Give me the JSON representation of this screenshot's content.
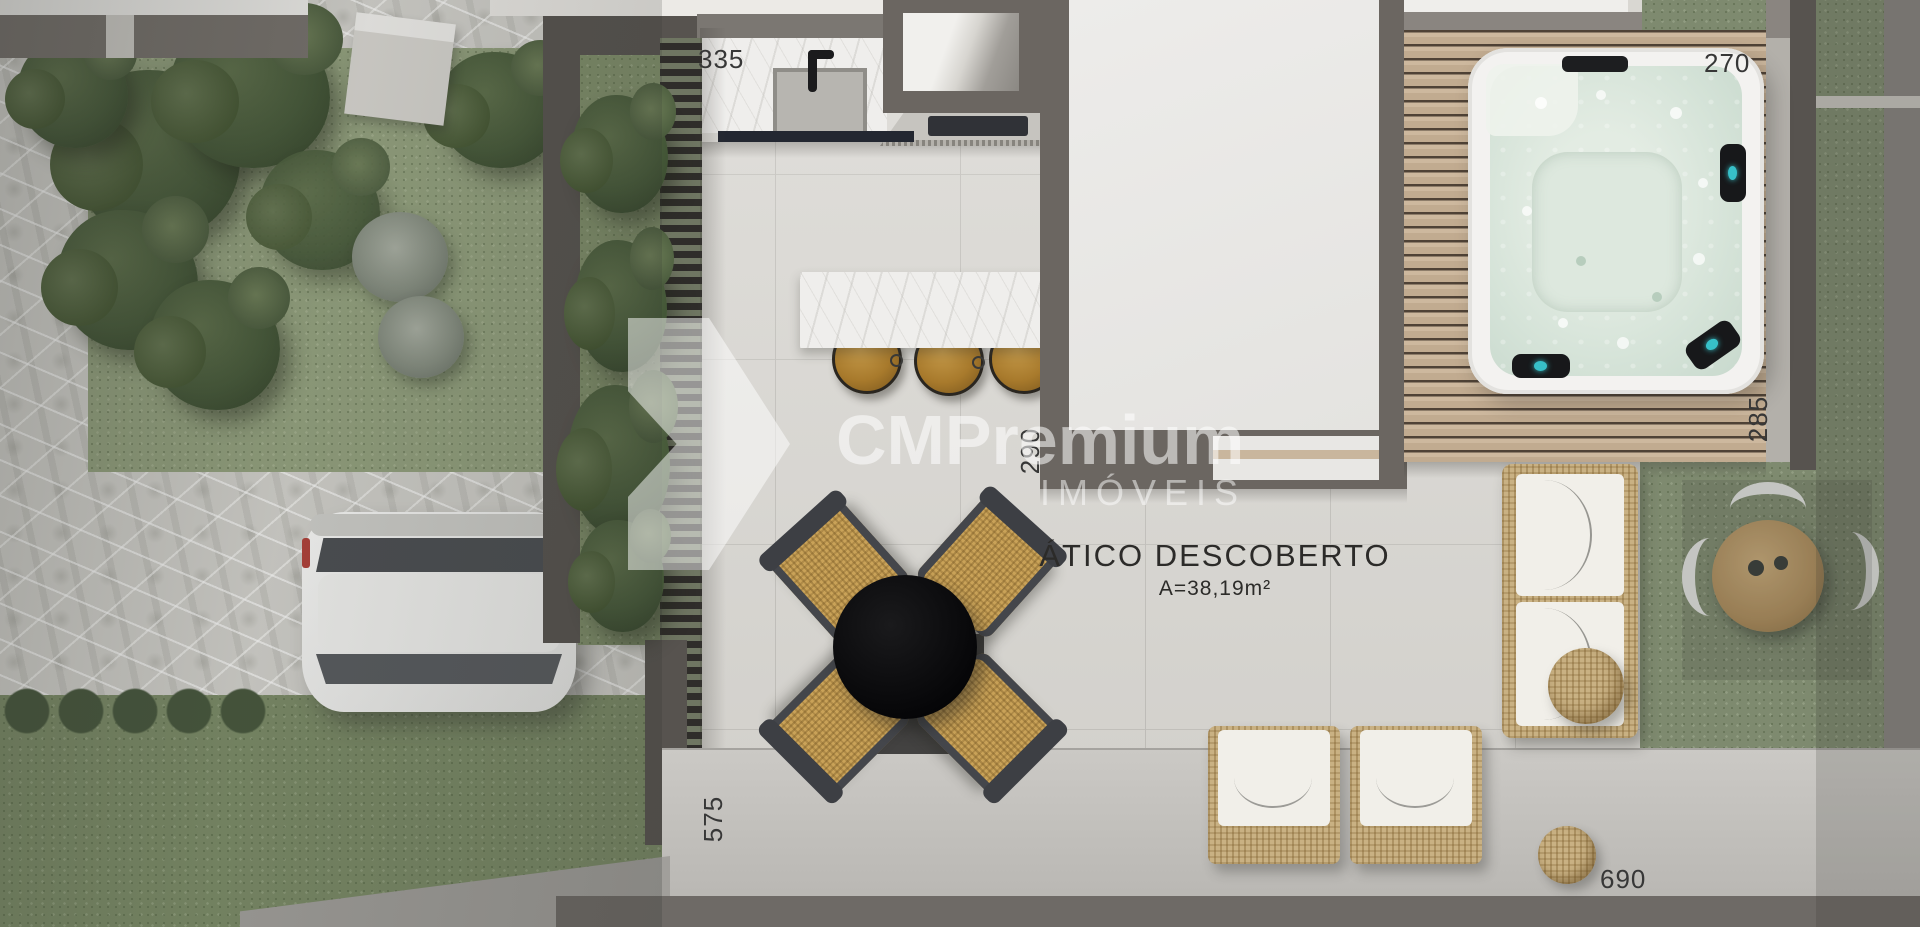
{
  "room": {
    "title": "ÁTICO DESCOBERTO",
    "area": "A=38,19m²"
  },
  "dimensions": {
    "kitchen_width": "335",
    "hot_tub_width": "270",
    "kitchen_depth": "290",
    "deck_depth": "285",
    "terrace_depth": "575",
    "terrace_width": "690"
  },
  "watermark": {
    "brand": "CMPremium",
    "subtitle": "IMÓVEIS"
  },
  "colors": {
    "wall": "#6b6661",
    "tile_floor": "#d9d7d2",
    "deck_wood": "#c8b49a",
    "hot_tub_water": "#d8e4da",
    "rattan": "#c9b183",
    "grass": "#93a17e",
    "stone": "#d2d1cc",
    "label_text": "#373737",
    "watermark_white": "rgba(255,255,255,0.55)"
  }
}
